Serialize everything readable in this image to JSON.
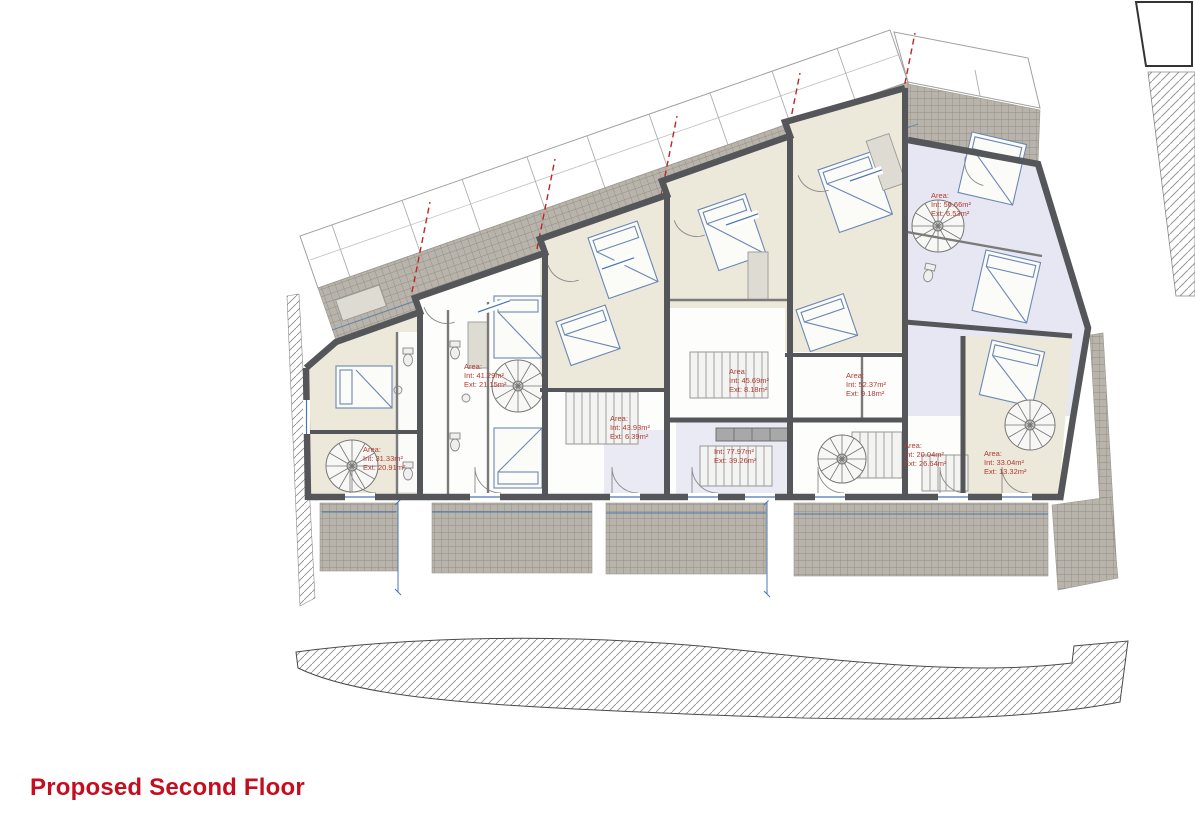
{
  "title": {
    "text": "Proposed Second Floor",
    "color": "#c40d1e"
  },
  "plan": {
    "name": "proposed-second-floor-plan",
    "area_labels": [
      {
        "prefix": "Area:",
        "int": "Int: 31.33m²",
        "ext": "Ext: 20.91m²",
        "x": 363,
        "y": 445
      },
      {
        "prefix": "Area:",
        "int": "Int: 41.29m²",
        "ext": "Ext: 21.15m²",
        "x": 464,
        "y": 362
      },
      {
        "prefix": "Area:",
        "int": "Int: 43.93m²",
        "ext": "Ext: 6.39m²",
        "x": 610,
        "y": 414
      },
      {
        "prefix": "",
        "int": "Int: 77.97m²",
        "ext": "Ext: 39.26m²",
        "x": 714,
        "y": 447
      },
      {
        "prefix": "Area:",
        "int": "Int: 45.69m²",
        "ext": "Ext: 8.18m²",
        "x": 729,
        "y": 367
      },
      {
        "prefix": "Area:",
        "int": "Int: 52.37m²",
        "ext": "Ext: 9.18m²",
        "x": 846,
        "y": 371
      },
      {
        "prefix": "Area:",
        "int": "Int: 20.04m²",
        "ext": "Ext: 26.64m²",
        "x": 904,
        "y": 441
      },
      {
        "prefix": "Area:",
        "int": "Int: 56.66m²",
        "ext": "Ext: 6.53m²",
        "x": 931,
        "y": 191
      },
      {
        "prefix": "Area:",
        "int": "Int: 33.04m²",
        "ext": "Ext: 13.32m²",
        "x": 984,
        "y": 449
      }
    ],
    "colors": {
      "title_red": "#c40d1e",
      "label_red": "#b23a33",
      "boundary_dashed_red": "#c22424",
      "wall_gray": "#55565a",
      "terrace_tile": "#b8b4ab",
      "terrace_tile_grid": "#928e85",
      "room_beige": "#ece8da",
      "room_lavender": "#e7e7f3",
      "drawing_blue": "#4a78b0",
      "hatch_gray": "#8f8f8f"
    }
  }
}
